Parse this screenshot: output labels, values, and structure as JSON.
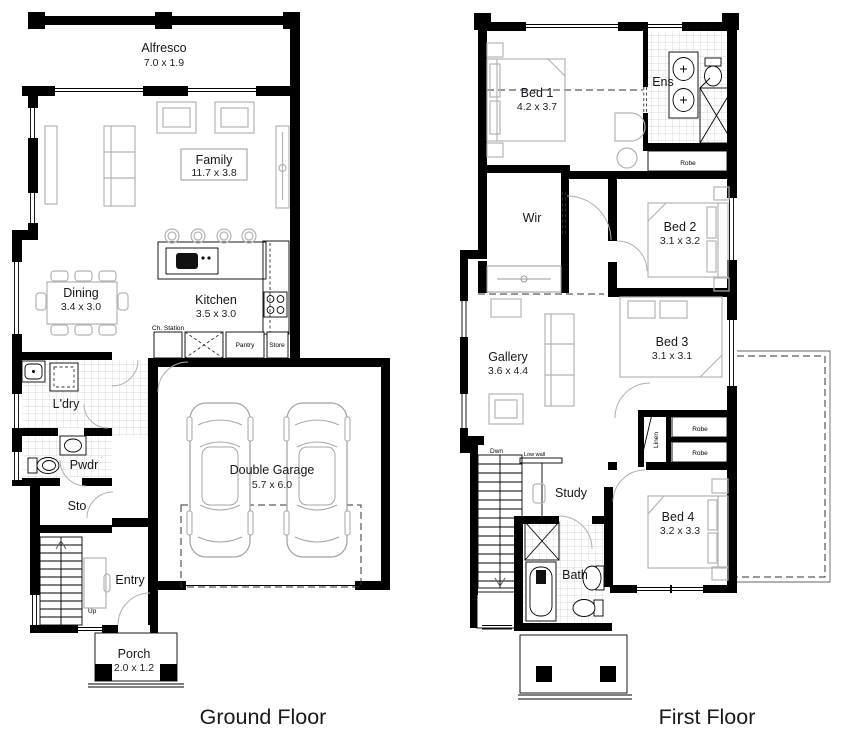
{
  "palette": {
    "wall": "#000000",
    "furniture_line": "#b3b3b3",
    "tile_line": "#cccccc",
    "label_text": "#16161f",
    "annotation_text": "#000000",
    "dashed_line": "#333333",
    "background": "#ffffff"
  },
  "ground_floor": {
    "title": "Ground Floor",
    "rooms": {
      "alfresco": {
        "name": "Alfresco",
        "dims": "7.0 x 1.9"
      },
      "family": {
        "name": "Family",
        "dims": "11.7 x 3.8"
      },
      "dining": {
        "name": "Dining",
        "dims": "3.4 x 3.0"
      },
      "kitchen": {
        "name": "Kitchen",
        "dims": "3.5 x 3.0"
      },
      "laundry": {
        "name": "L'dry"
      },
      "powder": {
        "name": "Pwdr"
      },
      "storage": {
        "name": "Sto"
      },
      "entry": {
        "name": "Entry"
      },
      "garage": {
        "name": "Double Garage",
        "dims": "5.7 x 6.0"
      },
      "porch": {
        "name": "Porch",
        "dims": "2.0 x 1.2"
      }
    },
    "annotations": {
      "ch_station": "Ch. Station",
      "pantry": "Pantry",
      "store": "Store",
      "up": "Up"
    }
  },
  "first_floor": {
    "title": "First Floor",
    "rooms": {
      "bed1": {
        "name": "Bed 1",
        "dims": "4.2 x 3.7"
      },
      "ens": {
        "name": "Ens"
      },
      "wir": {
        "name": "Wir"
      },
      "bed2": {
        "name": "Bed 2",
        "dims": "3.1 x 3.2"
      },
      "gallery": {
        "name": "Gallery",
        "dims": "3.6 x 4.4"
      },
      "bed3": {
        "name": "Bed 3",
        "dims": "3.1 x 3.1"
      },
      "study": {
        "name": "Study"
      },
      "bed4": {
        "name": "Bed 4",
        "dims": "3.2 x 3.3"
      },
      "bath": {
        "name": "Bath"
      }
    },
    "annotations": {
      "robe_ens": "Robe",
      "robe_bed4_a": "Robe",
      "robe_bed4_b": "Robe",
      "linen": "Linen",
      "dwn": "Dwn",
      "low_wall": "Low wall"
    }
  }
}
